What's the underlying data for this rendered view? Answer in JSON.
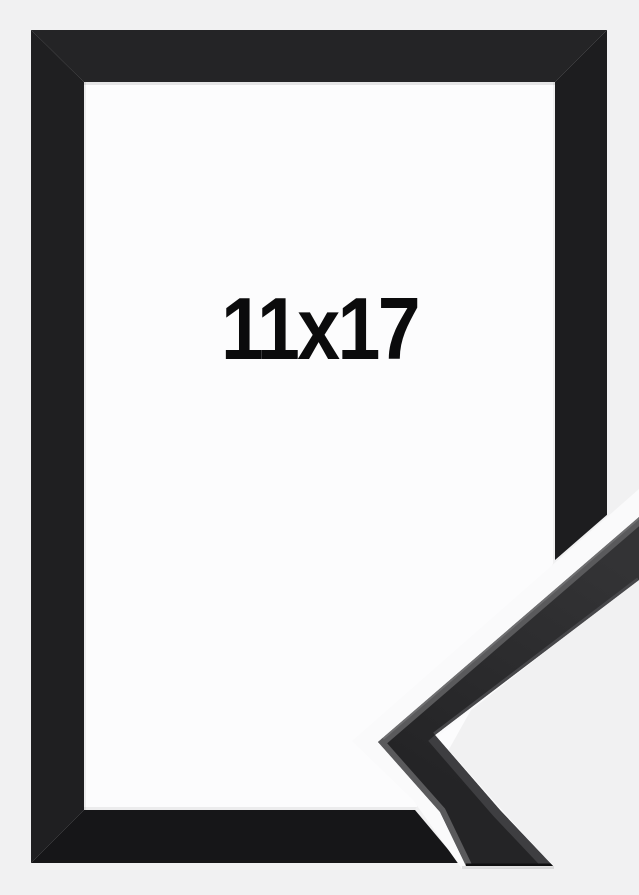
{
  "photo": {
    "size_label": "11x17"
  },
  "colors": {
    "background": "#f1f1f2",
    "mat": "#fcfcfd",
    "text": "#0b0b0c",
    "frame_top": "#242426",
    "frame_right": "#1d1d1f",
    "frame_bottom": "#161618",
    "frame_left": "#1f1f21",
    "gap_highlight": "#fafafb",
    "profile_face_light": "#333335",
    "profile_face_dark": "#242426",
    "profile_bevel": "#5a5a5c",
    "profile_bevel_bright": "#6e6e70",
    "profile_inner_edge": "#47474a",
    "profile_lower_face": "#3e3e41",
    "profile_bottom_cut": "#101011"
  }
}
